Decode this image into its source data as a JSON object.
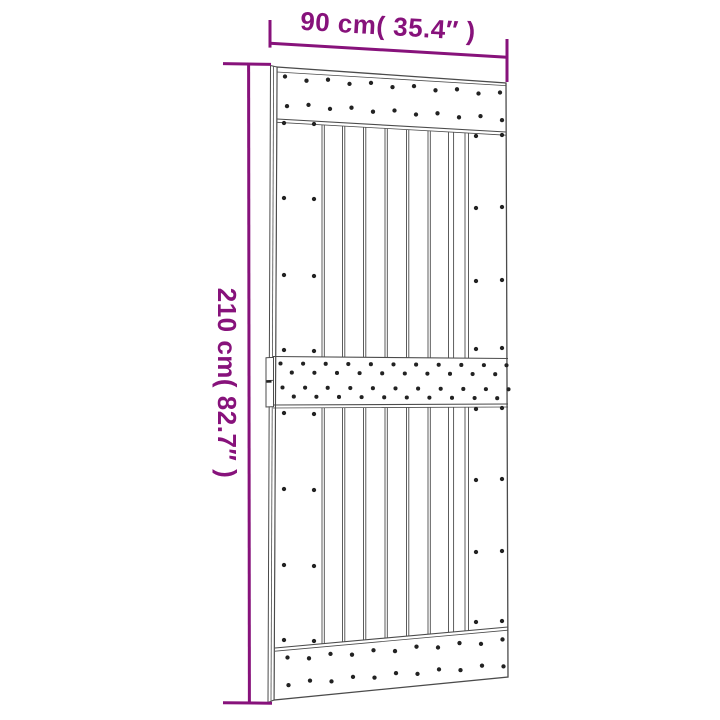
{
  "figure": {
    "width_label": "90 cm( 35.4″ )",
    "height_label": "210 cm( 82.7″ )",
    "dimensions": {
      "width": {
        "cm": "90",
        "inches": "35.4"
      },
      "height": {
        "cm": "210",
        "inches": "82.7"
      }
    }
  },
  "colors": {
    "dimension_accent": "#87127b",
    "drawing_line": "#4b4b4b",
    "screw_dot": "#222222",
    "background": "#ffffff"
  }
}
